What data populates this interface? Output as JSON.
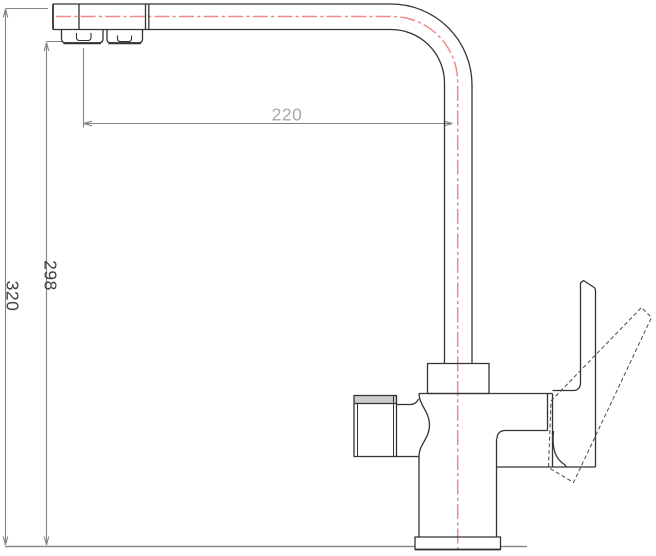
{
  "page": {
    "title": "Kitchen faucet technical drawing",
    "background": "#ffffff"
  },
  "drawing": {
    "object": "two-outlet-kitchen-mixer-faucet-side-view",
    "style": "cad-wireframe-line-drawing",
    "colors": {
      "outline": "#333333",
      "dimension_line": "#848484",
      "countertop_line": "#8a8a8a",
      "centerline_red": "#EE8A8A",
      "dim_text_dark": "#3f3f3f",
      "dim_text_light": "#a8a8a8",
      "cap_band_fill": "#cdcdcd"
    },
    "dimensions": [
      {
        "id": "spout-reach",
        "label": "220",
        "orientation": "horizontal"
      },
      {
        "id": "spout-outlet-height",
        "label": "298",
        "orientation": "vertical"
      },
      {
        "id": "overall-height",
        "label": "320",
        "orientation": "vertical"
      }
    ],
    "parts": [
      "spout-head",
      "aerator-filtered",
      "aerator-main",
      "spout-tube-bend",
      "mounting-collar",
      "faucet-body",
      "side-filter-outlet",
      "lever-handle-solid",
      "lever-handle-dashed-alt-position",
      "base-flange",
      "countertop-reference-line",
      "centerline"
    ]
  }
}
